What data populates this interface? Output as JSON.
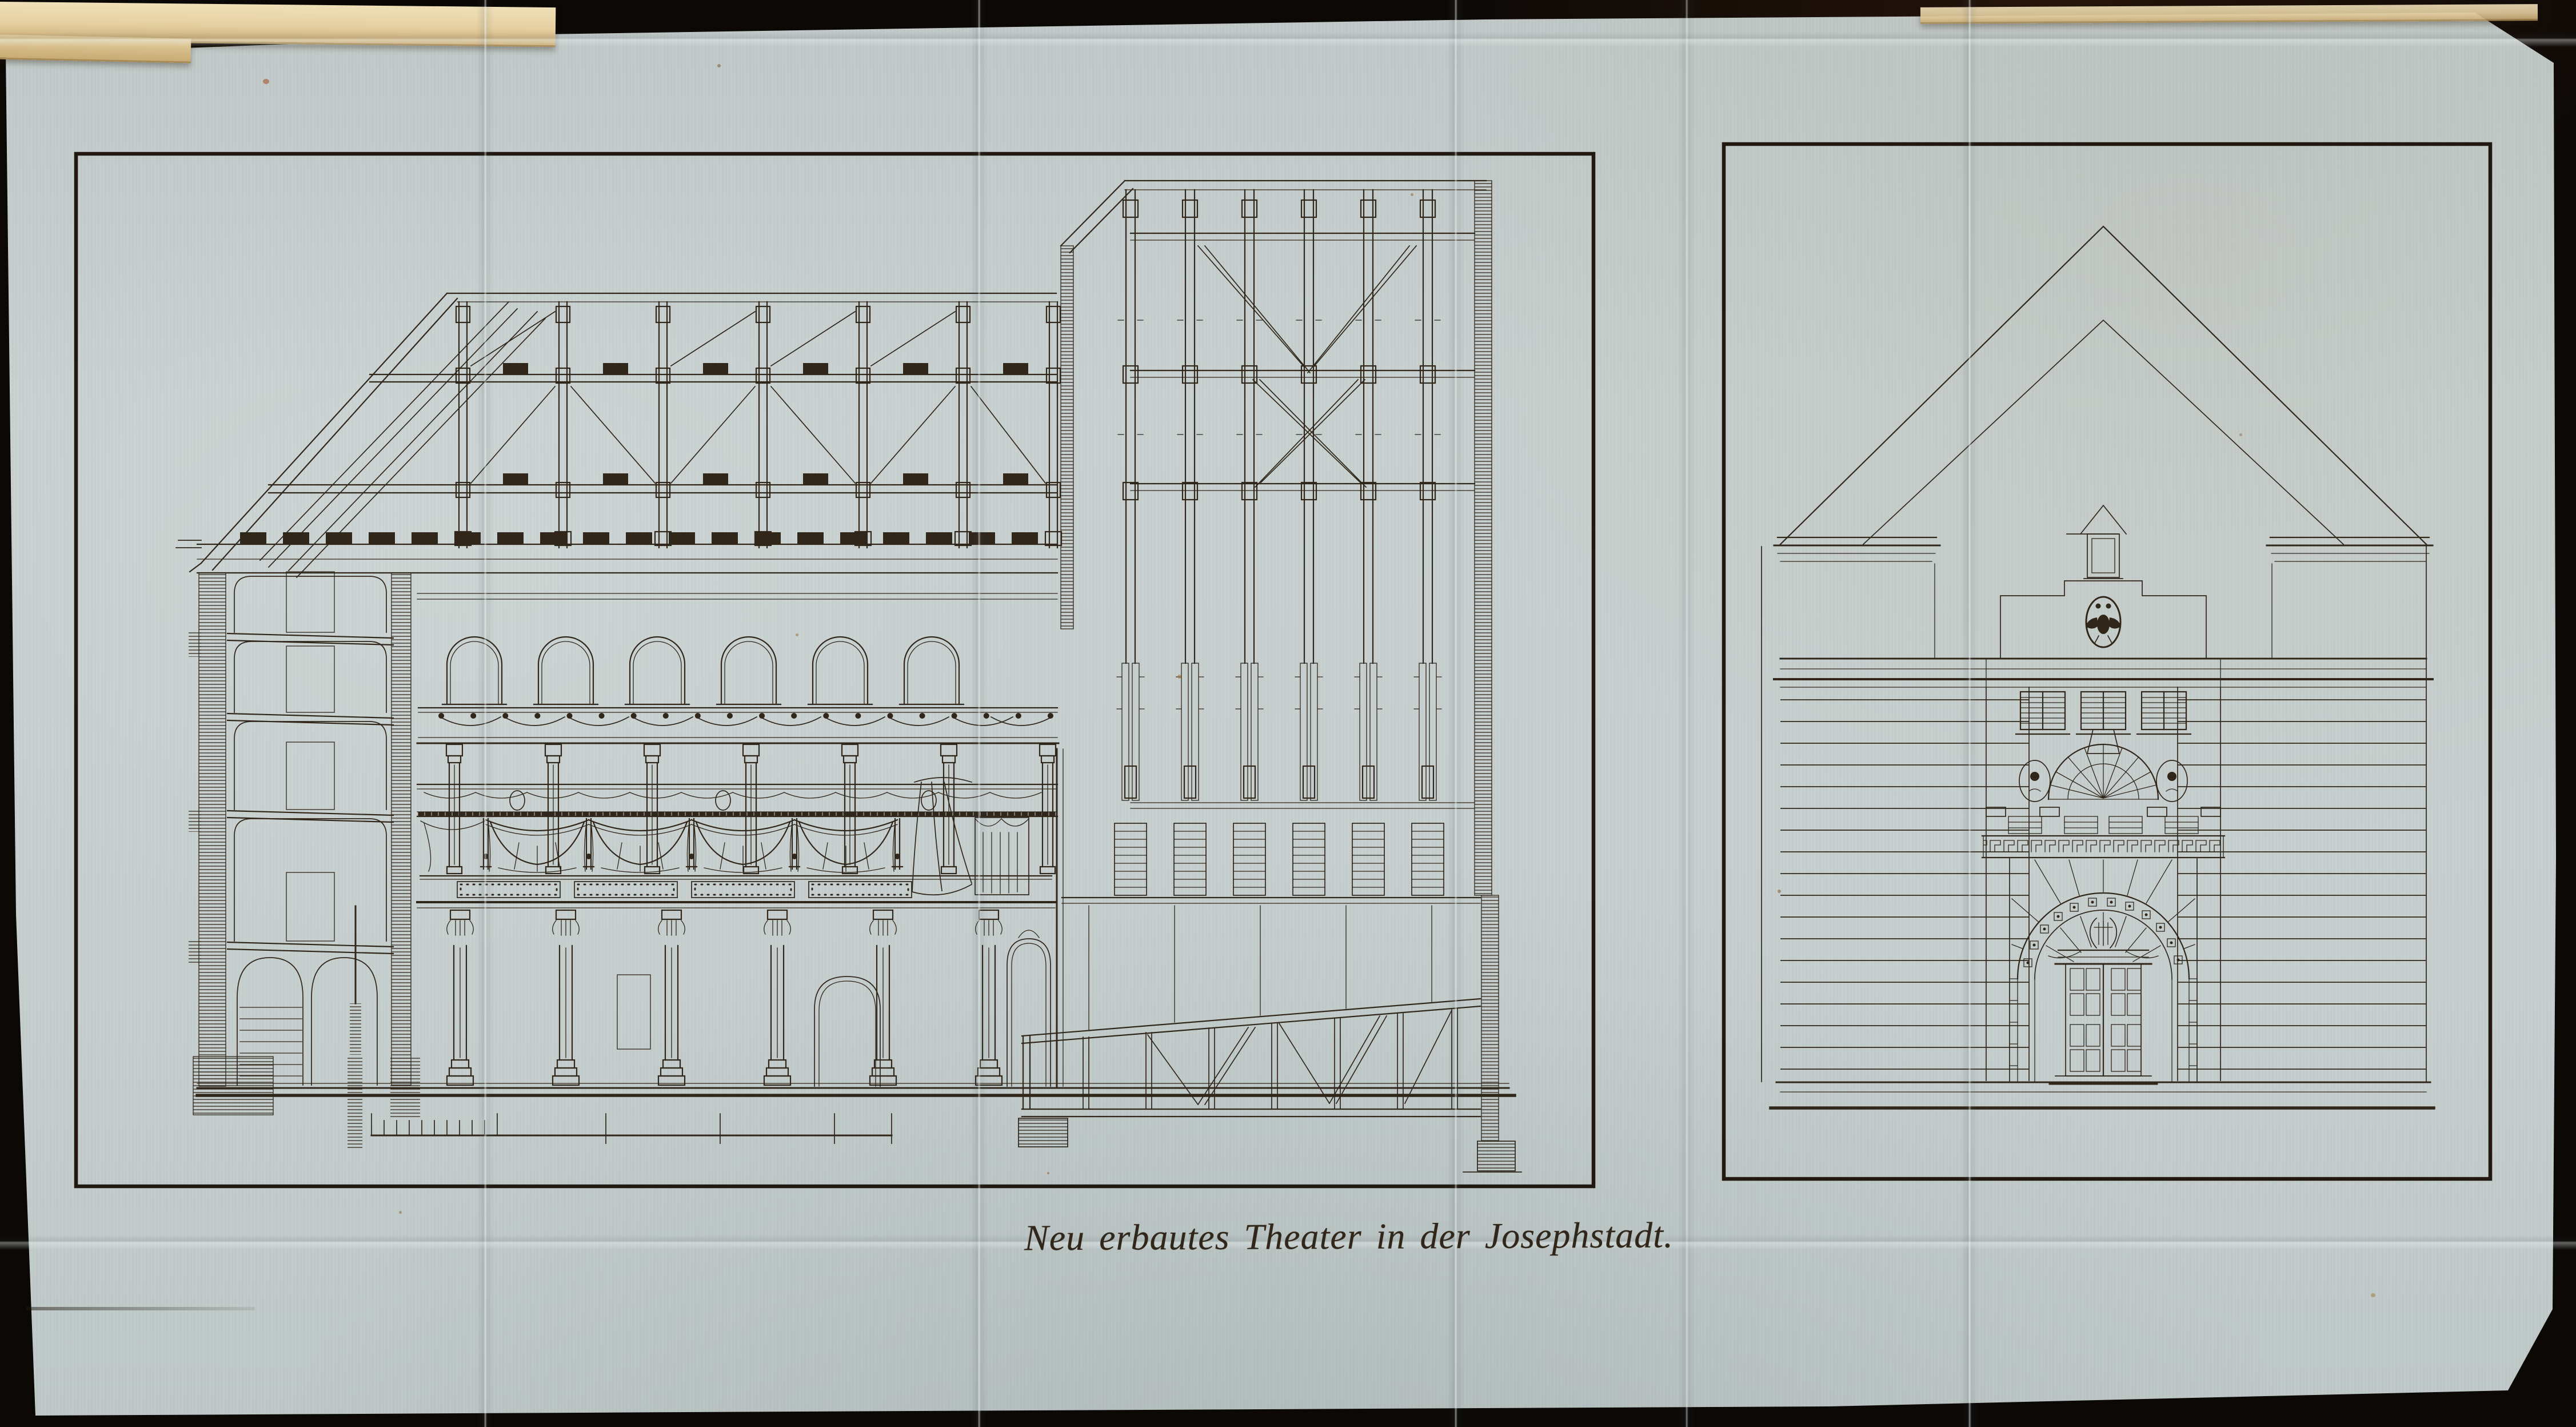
{
  "caption": {
    "text": "Neu erbautes Theater in der Josephstadt."
  },
  "colors": {
    "background": "#0b0806",
    "paper": "#c6cfce",
    "ink": "#30261a",
    "frame": "#211910",
    "pageEdge": "#e6d0a2",
    "pageEdgeDark": "#a98a55",
    "stain": "#9e4a1e"
  }
}
